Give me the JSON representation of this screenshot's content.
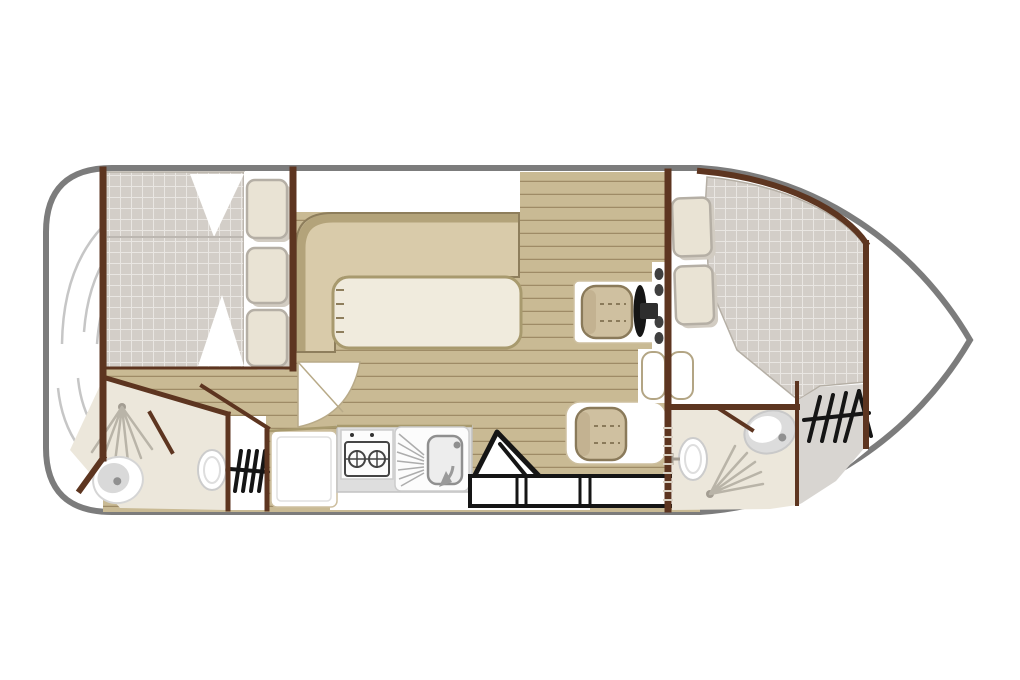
{
  "diagram": {
    "type": "boat-floor-plan",
    "orientation": "bow-right-stern-left",
    "rooms": [
      "aft-deck",
      "aft-cabin",
      "aft-bathroom",
      "saloon",
      "galley",
      "helm-station",
      "dinette",
      "forward-cabin",
      "forward-bathroom",
      "foredeck",
      "bow"
    ],
    "fixtures": [
      "double-bed-aft",
      "pillows-aft-x3",
      "swim-platform-steps",
      "shower-aft",
      "toilet-aft",
      "washbasin-aft",
      "companionway-steps-aft",
      "fridge",
      "stove-two-burner",
      "sink-with-drainer",
      "folding-chair",
      "storage-locker",
      "l-shaped-sofa",
      "saloon-table",
      "helm-seat",
      "steering-wheel",
      "instrument-panel",
      "dinette-seat",
      "twin-step-table",
      "wall-ladder",
      "double-bed-forward",
      "pillows-forward-x2",
      "shower-forward",
      "toilet-forward",
      "washbasin-forward",
      "deck-ladder-bow"
    ]
  },
  "colors": {
    "hull_outline": "#7c7c7c",
    "wall": "#5d3520",
    "wood": "#c9ba94",
    "plank_line": "#7a6340",
    "sofa": "#d9cbaa",
    "sofa_back": "#b3a37a",
    "sofa_border": "#8e7e5c",
    "table": "#f0ebdd",
    "table_border": "#a89a6e",
    "mattress": "#d3cec8",
    "mattress_grid": "#e9e6e2",
    "pillow": "#e9e3d4",
    "pillow_border": "#b5afa5",
    "pillow_shadow": "#d2ccc2",
    "bathroom": "#ece7db",
    "deck_gray": "#d8d5d1",
    "seat": "#cfc0a0",
    "seat_pad": "#c3b291",
    "seat_border": "#8a7a5a",
    "counter": "#dedede",
    "counter_border": "#c2c2c2",
    "fixture_border": "#cccccc",
    "fixture_gray": "#d9d9d9",
    "spray": "#b9b4a8",
    "step_arc": "#c6c6c6",
    "door_arc": "#b8aa88",
    "trim": "#cdbf9f",
    "rung": "#d9d0c2",
    "ink": "#151515",
    "ink2": "#444444"
  }
}
